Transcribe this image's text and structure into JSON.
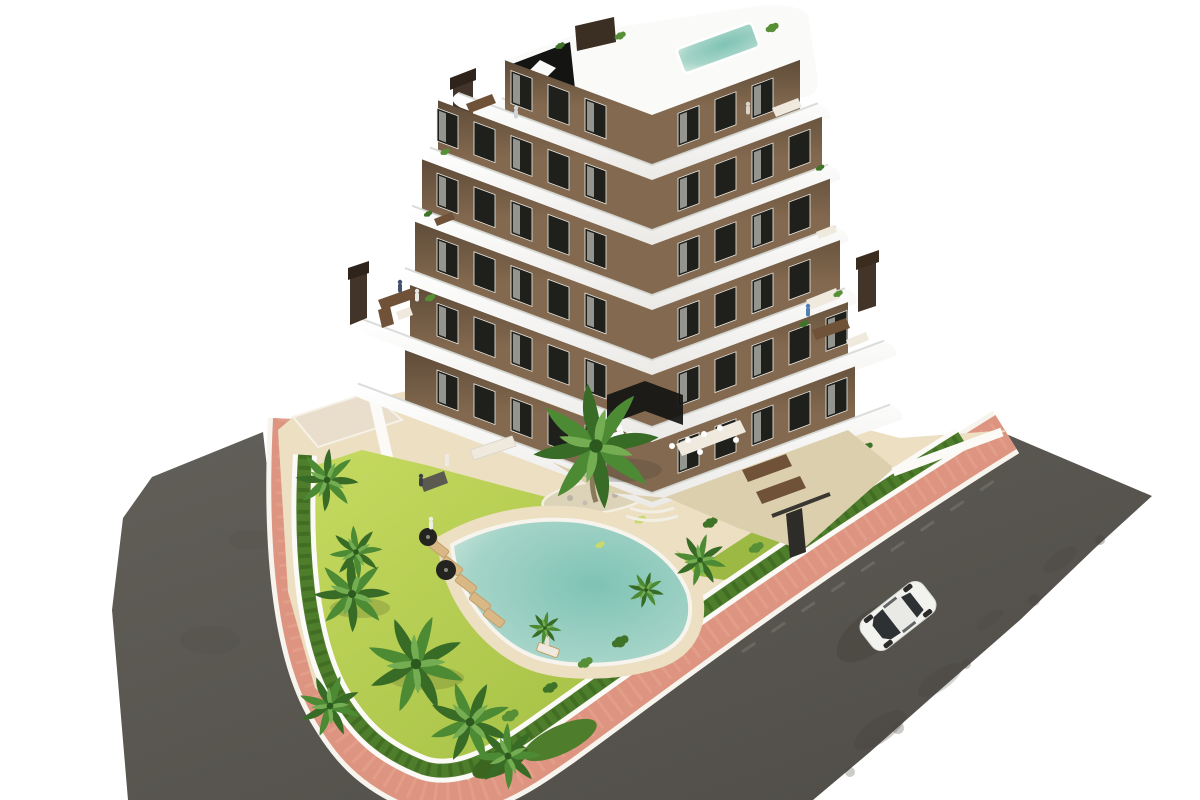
{
  "scene": {
    "type": "architectural-render",
    "description": "Aerial 3D rendering of a modern chevron-shaped apartment building with curved white balcony bands and brown facade, rooftop terraces with a small pool, a communal garden with lawn, palm trees, hedges and a free-form swimming pool with sun loungers, bordered by pink sidewalks and dark asphalt streets with a single white car driving by",
    "objects": {
      "building": {
        "wings": 2,
        "levels": 7,
        "facade": "brown",
        "balconies": "curved white bands",
        "chimneys": 2,
        "rooftop_pool": true,
        "stair_bulkhead": "black glass"
      },
      "garden": {
        "lawn": true,
        "hedge_border": true,
        "planting_island": true,
        "palm_trees": 12,
        "bushes": 14
      },
      "pool": {
        "shape": "freeform",
        "water": "turquoise",
        "deck": "sand",
        "sun_loungers": 6,
        "umbrellas": 2
      },
      "streets": {
        "count": 2,
        "surface": "asphalt",
        "sidewalk": "pink with white curbs",
        "corner": "rounded"
      },
      "car": {
        "count": 1,
        "color": "white",
        "heading": "southwest"
      },
      "people_visible": 10
    }
  },
  "building": {
    "floors": 6,
    "slope_deg": 20.4,
    "windows": {
      "w": 21,
      "h": 33,
      "y": 8,
      "start": 46,
      "gap": 37,
      "right_start": 26,
      "left_counts": [
        3,
        5,
        5,
        5,
        5,
        5
      ],
      "right_counts": [
        3,
        4,
        4,
        4,
        5,
        5
      ]
    }
  },
  "colors": {
    "road": "#5e5b55",
    "road_dark": "#45423d",
    "sidewalk": "#dd9582",
    "curb": "#f7f4ed",
    "hedge": "#4e7e2c",
    "hedge_dark": "#3c661f",
    "lawn": "#b9cf52",
    "lawn_dark": "#9cb944",
    "sand": "#ecdfc2",
    "sand_dark": "#e0d2ae",
    "patio": "#dccfae",
    "pool": "#84c4b6",
    "pool_deep": "#6fb4a8",
    "slab": "#ffffff",
    "slab_shade": "#e6e5e2",
    "facade": "#83694f",
    "facade_shade": "#5f4b36",
    "window": "#1f201c",
    "curtain": "#f6f5f1",
    "chimney": "#43342a",
    "wall": "#fbfaf6",
    "palm": "#4c8a34",
    "palm_dark": "#376b26",
    "palm_light": "#74ad52",
    "trunk": "#8a7a5c",
    "furniture_wood": "#6f5238",
    "furniture_white": "#efe9de",
    "car_body": "#f2f2ef",
    "car_glass": "#2e3133",
    "shadow": "#43403a"
  }
}
